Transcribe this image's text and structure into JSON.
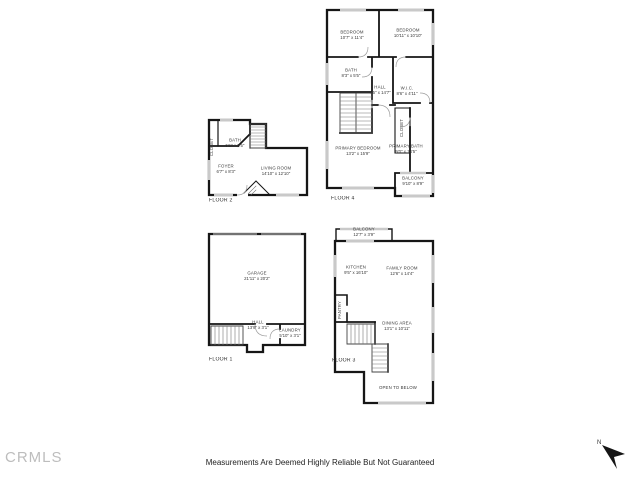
{
  "floors": [
    {
      "label": "FLOOR 1",
      "rooms": [
        {
          "name": "GARAGE",
          "dims": "21'11\" x 20'2\""
        },
        {
          "name": "HALL",
          "dims": "13'9\" x 3'1\""
        },
        {
          "name": "LAUNDRY",
          "dims": "5'10\" x 3'1\""
        }
      ]
    },
    {
      "label": "FLOOR 2",
      "rooms": [
        {
          "name": "BATH",
          "dims": "5'1\" x 8'5\""
        },
        {
          "name": "CLOSET",
          "dims": ""
        },
        {
          "name": "FOYER",
          "dims": "6'7\" x 8'3\""
        },
        {
          "name": "LIVING ROOM",
          "dims": "14'10\" x 12'10\""
        }
      ]
    },
    {
      "label": "FLOOR 3",
      "rooms": [
        {
          "name": "BALCONY",
          "dims": "12'7\" x 3'9\""
        },
        {
          "name": "KITCHEN",
          "dims": "9'5\" x 16'10\""
        },
        {
          "name": "FAMILY ROOM",
          "dims": "12'6\" x 14'4\""
        },
        {
          "name": "PANTRY",
          "dims": ""
        },
        {
          "name": "DINING AREA",
          "dims": "13'1\" x 10'11\""
        },
        {
          "name": "OPEN TO BELOW",
          "dims": ""
        }
      ]
    },
    {
      "label": "FLOOR 4",
      "rooms": [
        {
          "name": "BEDROOM",
          "dims": "10'7\" x 11'4\""
        },
        {
          "name": "BEDROOM",
          "dims": "10'11\" x 10'10\""
        },
        {
          "name": "BATH",
          "dims": "8'3\" x 5'5\""
        },
        {
          "name": "HALL",
          "dims": "4'5\" x 14'7\""
        },
        {
          "name": "W.I.C.",
          "dims": "8'6\" x 4'11\""
        },
        {
          "name": "CLOSET",
          "dims": ""
        },
        {
          "name": "PRIMARY BEDROOM",
          "dims": "13'2\" x 15'9\""
        },
        {
          "name": "PRIMARY BATH",
          "dims": "9'0\" x 14'5\""
        },
        {
          "name": "BALCONY",
          "dims": "9'10\" x 8'9\""
        }
      ]
    }
  ],
  "footer": {
    "logo": "CRMLS",
    "disclaimer": "Measurements Are Deemed Highly Reliable But Not Guaranteed",
    "compass_label": "N"
  },
  "colors": {
    "wall": "#161616",
    "window": "#c9c9c9",
    "label_text": "#3a3a3a",
    "logo": "#bdbdbd"
  }
}
